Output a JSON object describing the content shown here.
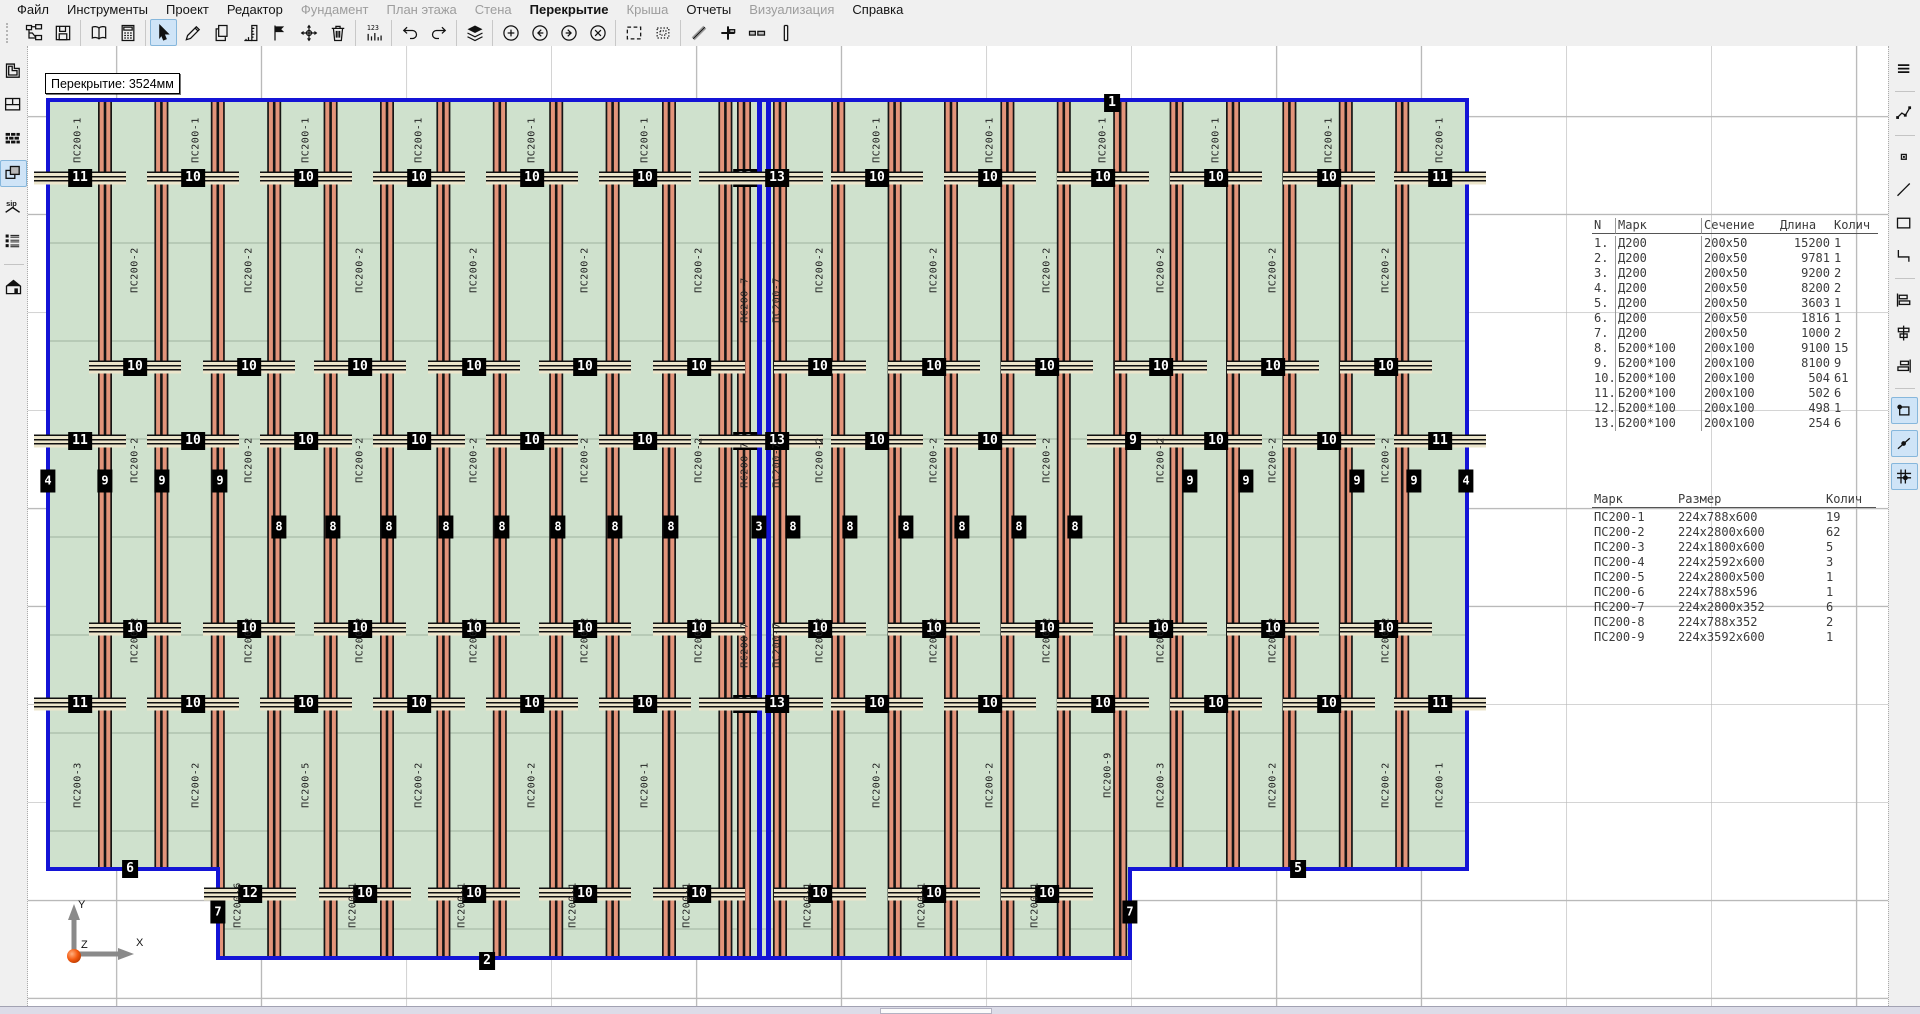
{
  "menu": {
    "items": [
      {
        "id": "file",
        "label": "Файл",
        "enabled": true,
        "active": false
      },
      {
        "id": "tools",
        "label": "Инструменты",
        "enabled": true,
        "active": false
      },
      {
        "id": "project",
        "label": "Проект",
        "enabled": true,
        "active": false
      },
      {
        "id": "editor",
        "label": "Редактор",
        "enabled": true,
        "active": false
      },
      {
        "id": "foundation",
        "label": "Фундамент",
        "enabled": false,
        "active": false
      },
      {
        "id": "floor-plan",
        "label": "План этажа",
        "enabled": false,
        "active": false
      },
      {
        "id": "wall",
        "label": "Стена",
        "enabled": false,
        "active": false
      },
      {
        "id": "slab",
        "label": "Перекрытие",
        "enabled": true,
        "active": true
      },
      {
        "id": "roof",
        "label": "Крыша",
        "enabled": false,
        "active": false
      },
      {
        "id": "reports",
        "label": "Отчеты",
        "enabled": true,
        "active": false
      },
      {
        "id": "visualization",
        "label": "Визуализация",
        "enabled": false,
        "active": false
      },
      {
        "id": "help",
        "label": "Справка",
        "enabled": true,
        "active": false
      }
    ]
  },
  "toolbar": {
    "active": "cursor",
    "groups": [
      [
        "project-tree",
        "save"
      ],
      [
        "book",
        "calculator"
      ],
      [
        "cursor",
        "pencil",
        "copy",
        "ruler",
        "flag",
        "move",
        "trash"
      ],
      [
        "numbering"
      ],
      [
        "undo",
        "redo"
      ],
      [
        "layers"
      ],
      [
        "zoom-in",
        "nav-back",
        "nav-forward",
        "close-circle"
      ],
      [
        "select-rect",
        "select-region"
      ],
      [
        "measure",
        "section-plus",
        "segments",
        "wall-profile"
      ]
    ]
  },
  "left_sidebar": {
    "items": [
      {
        "icon": "foundation",
        "active": false
      },
      {
        "icon": "floorplan",
        "active": false
      },
      {
        "icon": "walls",
        "active": false
      },
      {
        "icon": "slab",
        "active": true
      },
      {
        "icon": "sip-roof",
        "active": false
      },
      {
        "icon": "report-list",
        "active": false
      },
      {
        "icon": "house-3d",
        "active": false,
        "sep_before": true
      }
    ]
  },
  "right_sidebar": {
    "items": [
      {
        "icon": "menu",
        "active": false,
        "sep_after": true
      },
      {
        "icon": "polyline",
        "active": false,
        "sep_after": true
      },
      {
        "icon": "point",
        "active": false
      },
      {
        "icon": "line",
        "active": false
      },
      {
        "icon": "rectangle",
        "active": false
      },
      {
        "icon": "corner",
        "active": false,
        "sep_after": true
      },
      {
        "icon": "align-left",
        "active": false
      },
      {
        "icon": "align-middle",
        "active": false
      },
      {
        "icon": "align-right",
        "active": false,
        "sep_after": true
      },
      {
        "icon": "snap-corner",
        "active": true
      },
      {
        "icon": "snap-line",
        "active": true
      },
      {
        "icon": "snap-grid",
        "active": true
      }
    ]
  },
  "tooltip": {
    "text": "Перекрытие: 3524мм"
  },
  "axes": {
    "x": "X",
    "y": "Y",
    "z": "Z"
  },
  "drawing": {
    "colors": {
      "panel_fill": "#cfe1cd",
      "joist": "#e3947a",
      "joist_edge": "#151515",
      "outline": "#1414d6",
      "joint_line": "#9fb49f",
      "stripe_cream": "#ece5cb"
    },
    "badge_rows": [
      {
        "y": 178,
        "stripe": true,
        "small": false,
        "items": [
          [
            80,
            "11"
          ],
          [
            193,
            "10"
          ],
          [
            306,
            "10"
          ],
          [
            419,
            "10"
          ],
          [
            532,
            "10"
          ],
          [
            645,
            "10"
          ],
          [
            745,
            "13"
          ],
          [
            777,
            "13"
          ],
          [
            877,
            "10"
          ],
          [
            990,
            "10"
          ],
          [
            1103,
            "10"
          ],
          [
            1216,
            "10"
          ],
          [
            1329,
            "10"
          ],
          [
            1440,
            "11"
          ]
        ]
      },
      {
        "y": 367,
        "stripe": true,
        "small": false,
        "items": [
          [
            135,
            "10"
          ],
          [
            249,
            "10"
          ],
          [
            360,
            "10"
          ],
          [
            474,
            "10"
          ],
          [
            585,
            "10"
          ],
          [
            699,
            "10"
          ],
          [
            820,
            "10"
          ],
          [
            934,
            "10"
          ],
          [
            1047,
            "10"
          ],
          [
            1161,
            "10"
          ],
          [
            1273,
            "10"
          ],
          [
            1386,
            "10"
          ]
        ]
      },
      {
        "y": 441,
        "stripe": true,
        "small": false,
        "items": [
          [
            80,
            "11"
          ],
          [
            193,
            "10"
          ],
          [
            306,
            "10"
          ],
          [
            419,
            "10"
          ],
          [
            532,
            "10"
          ],
          [
            645,
            "10"
          ],
          [
            745,
            "13"
          ],
          [
            777,
            "13"
          ],
          [
            877,
            "10"
          ],
          [
            990,
            "10"
          ],
          [
            1133,
            "9"
          ],
          [
            1216,
            "10"
          ],
          [
            1329,
            "10"
          ],
          [
            1440,
            "11"
          ]
        ]
      },
      {
        "y": 481,
        "stripe": false,
        "small": true,
        "items": [
          [
            48,
            "4"
          ],
          [
            105,
            "9"
          ],
          [
            162,
            "9"
          ],
          [
            220,
            "9"
          ],
          [
            1190,
            "9"
          ],
          [
            1246,
            "9"
          ],
          [
            1357,
            "9"
          ],
          [
            1414,
            "9"
          ],
          [
            1466,
            "4"
          ]
        ]
      },
      {
        "y": 527,
        "stripe": false,
        "small": true,
        "items": [
          [
            279,
            "8"
          ],
          [
            333,
            "8"
          ],
          [
            389,
            "8"
          ],
          [
            446,
            "8"
          ],
          [
            502,
            "8"
          ],
          [
            558,
            "8"
          ],
          [
            615,
            "8"
          ],
          [
            671,
            "8"
          ],
          [
            759,
            "3"
          ],
          [
            793,
            "8"
          ],
          [
            850,
            "8"
          ],
          [
            906,
            "8"
          ],
          [
            962,
            "8"
          ],
          [
            1019,
            "8"
          ],
          [
            1075,
            "8"
          ]
        ]
      },
      {
        "y": 629,
        "stripe": true,
        "small": false,
        "items": [
          [
            135,
            "10"
          ],
          [
            249,
            "10"
          ],
          [
            360,
            "10"
          ],
          [
            474,
            "10"
          ],
          [
            585,
            "10"
          ],
          [
            699,
            "10"
          ],
          [
            820,
            "10"
          ],
          [
            934,
            "10"
          ],
          [
            1047,
            "10"
          ],
          [
            1161,
            "10"
          ],
          [
            1273,
            "10"
          ],
          [
            1386,
            "10"
          ]
        ]
      },
      {
        "y": 704,
        "stripe": true,
        "small": false,
        "items": [
          [
            80,
            "11"
          ],
          [
            193,
            "10"
          ],
          [
            306,
            "10"
          ],
          [
            419,
            "10"
          ],
          [
            532,
            "10"
          ],
          [
            645,
            "10"
          ],
          [
            745,
            "13"
          ],
          [
            777,
            "13"
          ],
          [
            877,
            "10"
          ],
          [
            990,
            "10"
          ],
          [
            1103,
            "10"
          ],
          [
            1216,
            "10"
          ],
          [
            1329,
            "10"
          ],
          [
            1440,
            "11"
          ]
        ]
      },
      {
        "y": 894,
        "stripe": true,
        "small": false,
        "items": [
          [
            250,
            "12"
          ],
          [
            365,
            "10"
          ],
          [
            474,
            "10"
          ],
          [
            585,
            "10"
          ],
          [
            699,
            "10"
          ],
          [
            820,
            "10"
          ],
          [
            934,
            "10"
          ],
          [
            1047,
            "10"
          ]
        ]
      },
      {
        "y": 103,
        "stripe": false,
        "small": false,
        "items": [
          [
            1112,
            "1"
          ]
        ]
      },
      {
        "y": 869,
        "stripe": false,
        "small": false,
        "items": [
          [
            130,
            "6"
          ],
          [
            1298,
            "5"
          ]
        ]
      },
      {
        "y": 912,
        "stripe": false,
        "small": true,
        "items": [
          [
            218,
            "7"
          ],
          [
            1130,
            "7"
          ]
        ]
      },
      {
        "y": 961,
        "stripe": false,
        "small": false,
        "items": [
          [
            487,
            "2"
          ]
        ]
      }
    ],
    "label_rows": [
      {
        "y": 140,
        "text": "ПС200-1",
        "xs": [
          78,
          196,
          306,
          419,
          532,
          645,
          877,
          990,
          1103,
          1216,
          1329,
          1440
        ]
      },
      {
        "y": 270,
        "text": "ПС200-2",
        "xs": [
          135,
          249,
          360,
          474,
          585,
          699,
          820,
          934,
          1047,
          1161,
          1273,
          1386
        ]
      },
      {
        "y": 300,
        "text": "ПС200-7",
        "xs": [
          745,
          777
        ]
      },
      {
        "y": 460,
        "text": "ПС200-2",
        "xs": [
          135,
          249,
          360,
          474,
          585,
          699,
          820,
          934,
          1047,
          1161,
          1273,
          1386
        ]
      },
      {
        "y": 465,
        "text": "ПС200-7",
        "xs": [
          745,
          777
        ]
      },
      {
        "y": 640,
        "text": "ПС200-2",
        "xs": [
          135,
          249,
          360,
          474,
          585,
          699,
          820,
          934,
          1047,
          1161,
          1273,
          1386
        ]
      },
      {
        "y": 645,
        "text": "ПС200-7",
        "xs": [
          745,
          777
        ]
      },
      {
        "y": 785,
        "text": "ПС200-2",
        "xs": [
          196,
          419,
          532,
          877,
          990,
          1273,
          1386
        ]
      },
      {
        "y": 785,
        "text": "ПС200-3",
        "xs": [
          78,
          1161
        ]
      },
      {
        "y": 785,
        "text": "ПС200-5",
        "xs": [
          306
        ]
      },
      {
        "y": 785,
        "text": "ПС200-1",
        "xs": [
          645,
          1440
        ]
      },
      {
        "y": 775,
        "text": "ПС200-9",
        "xs": [
          1108
        ]
      },
      {
        "y": 905,
        "text": "ПС200-6",
        "xs": [
          238
        ]
      },
      {
        "y": 905,
        "text": "ПС200-1",
        "xs": [
          353,
          462,
          573,
          687,
          808,
          922,
          1035
        ]
      }
    ]
  },
  "tables": {
    "cut_list": {
      "headers": [
        "N",
        "Марк",
        "Сечение",
        "Длина",
        "Колич"
      ],
      "rows": [
        [
          "1.",
          "Д200",
          "200x50",
          "15200",
          "1"
        ],
        [
          "2.",
          "Д200",
          "200x50",
          "9781",
          "1"
        ],
        [
          "3.",
          "Д200",
          "200x50",
          "9200",
          "2"
        ],
        [
          "4.",
          "Д200",
          "200x50",
          "8200",
          "2"
        ],
        [
          "5.",
          "Д200",
          "200x50",
          "3603",
          "1"
        ],
        [
          "6.",
          "Д200",
          "200x50",
          "1816",
          "1"
        ],
        [
          "7.",
          "Д200",
          "200x50",
          "1000",
          "2"
        ],
        [
          "8.",
          "Б200*100",
          "200x100",
          "9100",
          "15"
        ],
        [
          "9.",
          "Б200*100",
          "200x100",
          "8100",
          "9"
        ],
        [
          "10.",
          "Б200*100",
          "200x100",
          "504",
          "61"
        ],
        [
          "11.",
          "Б200*100",
          "200x100",
          "502",
          "6"
        ],
        [
          "12.",
          "Б200*100",
          "200x100",
          "498",
          "1"
        ],
        [
          "13.",
          "Б200*100",
          "200x100",
          "254",
          "6"
        ]
      ]
    },
    "panel_list": {
      "headers": [
        "Марк",
        "Размер",
        "Колич"
      ],
      "rows": [
        [
          "ПС200-1",
          "224x788x600",
          "19"
        ],
        [
          "ПС200-2",
          "224x2800x600",
          "62"
        ],
        [
          "ПС200-3",
          "224x1800x600",
          "5"
        ],
        [
          "ПС200-4",
          "224x2592x600",
          "3"
        ],
        [
          "ПС200-5",
          "224x2800x500",
          "1"
        ],
        [
          "ПС200-6",
          "224x788x596",
          "1"
        ],
        [
          "ПС200-7",
          "224x2800x352",
          "6"
        ],
        [
          "ПС200-8",
          "224x788x352",
          "2"
        ],
        [
          "ПС200-9",
          "224x3592x600",
          "1"
        ]
      ]
    }
  }
}
